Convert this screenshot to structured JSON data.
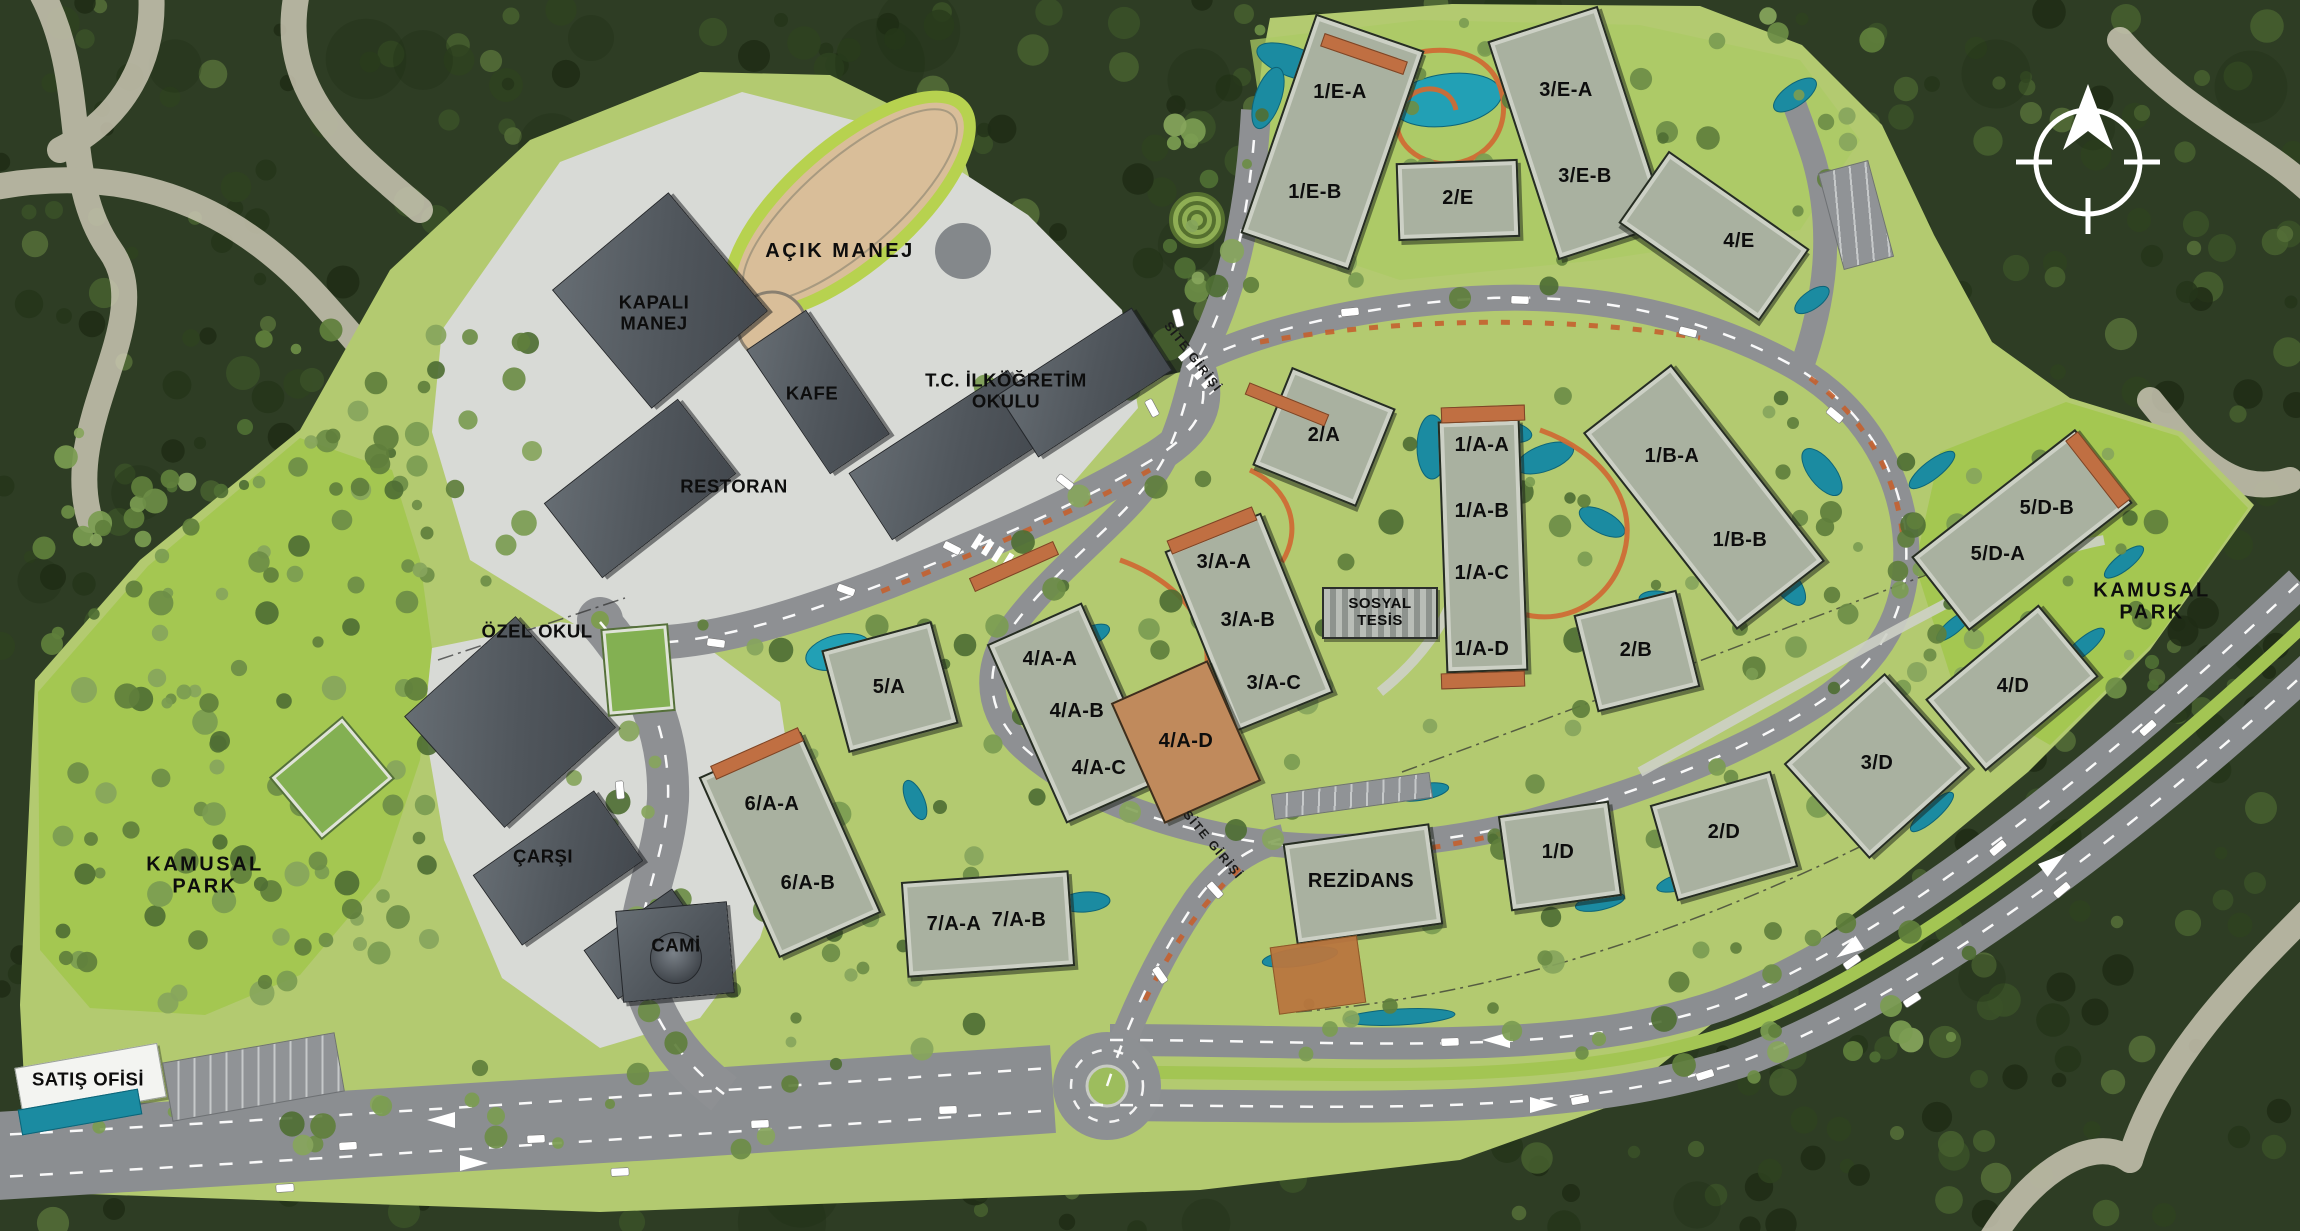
{
  "site_plan": {
    "colors": {
      "forest": "#2e3d24",
      "site_green": "#b3ca70",
      "park_green": "#a4c751",
      "road": "#8e9093",
      "pavement": "#d8dad6",
      "roof": "#a9b1a0",
      "roof_dark": "#53585d",
      "terracotta": "#c06f42",
      "water": "#1b8ba1",
      "trail_orange": "#cf6b35",
      "label": "#0d0d0d",
      "compass": "#ffffff"
    },
    "area_labels": [
      {
        "text": "KAMUSAL\nPARK",
        "x": 205,
        "y": 876
      },
      {
        "text": "KAMUSAL\nPARK",
        "x": 2152,
        "y": 602
      },
      {
        "text": "AÇIK MANEJ",
        "x": 840,
        "y": 251
      }
    ],
    "road_labels": [
      {
        "text": "SİTE GİRİŞİ",
        "x": 1193,
        "y": 357,
        "rot": 52
      },
      {
        "text": "SİTE GİRİŞİ",
        "x": 1213,
        "y": 845,
        "rot": 50
      }
    ],
    "buildings": [
      {
        "name": "block-1E",
        "kind": "res",
        "x": 1332,
        "y": 142,
        "w": 115,
        "h": 232,
        "rot": 19,
        "labels": [
          {
            "t": "1/E-A",
            "x": 1340,
            "y": 92
          },
          {
            "t": "1/E-B",
            "x": 1315,
            "y": 192
          }
        ]
      },
      {
        "name": "block-2E",
        "kind": "res",
        "x": 1458,
        "y": 200,
        "w": 122,
        "h": 78,
        "rot": -2,
        "labels": [
          {
            "t": "2/E",
            "x": 1458,
            "y": 198
          }
        ]
      },
      {
        "name": "block-3E",
        "kind": "res",
        "x": 1578,
        "y": 133,
        "w": 116,
        "h": 230,
        "rot": -18,
        "labels": [
          {
            "t": "3/E-A",
            "x": 1566,
            "y": 90
          },
          {
            "t": "3/E-B",
            "x": 1585,
            "y": 176
          }
        ]
      },
      {
        "name": "block-4E",
        "kind": "res",
        "x": 1714,
        "y": 236,
        "w": 172,
        "h": 88,
        "rot": 35,
        "labels": [
          {
            "t": "4/E",
            "x": 1739,
            "y": 241
          }
        ]
      },
      {
        "name": "block-2A",
        "kind": "res",
        "x": 1324,
        "y": 437,
        "w": 112,
        "h": 106,
        "rot": 22,
        "labels": [
          {
            "t": "2/A",
            "x": 1324,
            "y": 435
          }
        ]
      },
      {
        "name": "block-1A",
        "kind": "res",
        "x": 1483,
        "y": 546,
        "w": 82,
        "h": 252,
        "rot": -2,
        "labels": [
          {
            "t": "1/A-A",
            "x": 1482,
            "y": 445
          },
          {
            "t": "1/A-B",
            "x": 1482,
            "y": 511
          },
          {
            "t": "1/A-C",
            "x": 1482,
            "y": 573
          },
          {
            "t": "1/A-D",
            "x": 1482,
            "y": 649
          }
        ]
      },
      {
        "name": "block-3A",
        "kind": "res",
        "x": 1249,
        "y": 622,
        "w": 104,
        "h": 194,
        "rot": -22,
        "labels": [
          {
            "t": "3/A-A",
            "x": 1224,
            "y": 562
          },
          {
            "t": "3/A-B",
            "x": 1248,
            "y": 620
          },
          {
            "t": "3/A-C",
            "x": 1274,
            "y": 683
          }
        ]
      },
      {
        "name": "block-4A",
        "kind": "res",
        "x": 1074,
        "y": 713,
        "w": 104,
        "h": 196,
        "rot": -24,
        "labels": [
          {
            "t": "4/A-A",
            "x": 1050,
            "y": 659
          },
          {
            "t": "4/A-B",
            "x": 1077,
            "y": 711
          },
          {
            "t": "4/A-C",
            "x": 1099,
            "y": 768
          }
        ]
      },
      {
        "name": "block-4AD",
        "kind": "orange",
        "x": 1186,
        "y": 742,
        "w": 106,
        "h": 132,
        "rot": -24,
        "labels": [
          {
            "t": "4/A-D",
            "x": 1186,
            "y": 741
          }
        ]
      },
      {
        "name": "block-5A",
        "kind": "res",
        "x": 890,
        "y": 687,
        "w": 114,
        "h": 106,
        "rot": -15,
        "labels": [
          {
            "t": "5/A",
            "x": 889,
            "y": 687
          }
        ]
      },
      {
        "name": "block-6A",
        "kind": "res",
        "x": 790,
        "y": 845,
        "w": 112,
        "h": 198,
        "rot": -24,
        "labels": [
          {
            "t": "6/A-A",
            "x": 772,
            "y": 804
          },
          {
            "t": "6/A-B",
            "x": 808,
            "y": 883
          }
        ]
      },
      {
        "name": "block-7A",
        "kind": "res",
        "x": 988,
        "y": 924,
        "w": 168,
        "h": 96,
        "rot": -4,
        "labels": [
          {
            "t": "7/A-A",
            "x": 954,
            "y": 924
          },
          {
            "t": "7/A-B",
            "x": 1019,
            "y": 920
          }
        ]
      },
      {
        "name": "block-1B",
        "kind": "res",
        "x": 1704,
        "y": 497,
        "w": 112,
        "h": 250,
        "rot": -38,
        "labels": [
          {
            "t": "1/B-A",
            "x": 1672,
            "y": 456
          },
          {
            "t": "1/B-B",
            "x": 1740,
            "y": 540
          }
        ]
      },
      {
        "name": "block-2B",
        "kind": "res",
        "x": 1637,
        "y": 651,
        "w": 106,
        "h": 100,
        "rot": -14,
        "labels": [
          {
            "t": "2/B",
            "x": 1636,
            "y": 650
          }
        ]
      },
      {
        "name": "block-5D",
        "kind": "res",
        "x": 2022,
        "y": 530,
        "w": 208,
        "h": 94,
        "rot": -38,
        "labels": [
          {
            "t": "5/D-B",
            "x": 2047,
            "y": 508
          },
          {
            "t": "5/D-A",
            "x": 1998,
            "y": 554
          }
        ]
      },
      {
        "name": "block-4D",
        "kind": "res",
        "x": 2012,
        "y": 688,
        "w": 148,
        "h": 94,
        "rot": -40,
        "labels": [
          {
            "t": "4/D",
            "x": 2013,
            "y": 686
          }
        ]
      },
      {
        "name": "block-3D",
        "kind": "res",
        "x": 1877,
        "y": 766,
        "w": 136,
        "h": 128,
        "rot": -42,
        "labels": [
          {
            "t": "3/D",
            "x": 1877,
            "y": 763
          }
        ]
      },
      {
        "name": "block-2D",
        "kind": "res",
        "x": 1724,
        "y": 836,
        "w": 126,
        "h": 100,
        "rot": -16,
        "labels": [
          {
            "t": "2/D",
            "x": 1724,
            "y": 832
          }
        ]
      },
      {
        "name": "block-1D",
        "kind": "res",
        "x": 1560,
        "y": 856,
        "w": 112,
        "h": 96,
        "rot": -8,
        "labels": [
          {
            "t": "1/D",
            "x": 1558,
            "y": 852
          }
        ]
      },
      {
        "name": "rezidans",
        "kind": "res",
        "x": 1363,
        "y": 884,
        "w": 148,
        "h": 102,
        "rot": -8,
        "labels": [
          {
            "t": "REZİDANS",
            "x": 1361,
            "y": 881
          }
        ]
      },
      {
        "name": "kapali-manej",
        "kind": "dark",
        "x": 660,
        "y": 300,
        "w": 152,
        "h": 155,
        "rot": -40,
        "labels": [
          {
            "t": "KAPALI\nMANEJ",
            "x": 654,
            "y": 313,
            "cls": "fac"
          }
        ]
      },
      {
        "name": "kafe",
        "kind": "dark",
        "x": 818,
        "y": 392,
        "w": 72,
        "h": 150,
        "rot": -34,
        "labels": [
          {
            "t": "KAFE",
            "x": 812,
            "y": 394,
            "cls": "fac"
          }
        ]
      },
      {
        "name": "okul-wing-a",
        "kind": "dark",
        "x": 950,
        "y": 455,
        "w": 190,
        "h": 80,
        "rot": -33
      },
      {
        "name": "okul-wing-b",
        "kind": "dark",
        "x": 1085,
        "y": 382,
        "w": 160,
        "h": 75,
        "rot": -33,
        "labels": [
          {
            "t": "T.C. İLKÖĞRETİM\nOKULU",
            "x": 1006,
            "y": 391,
            "cls": "fac"
          }
        ]
      },
      {
        "name": "restoran",
        "kind": "dark",
        "x": 640,
        "y": 488,
        "w": 170,
        "h": 95,
        "rot": -38,
        "labels": [
          {
            "t": "RESTORAN",
            "x": 734,
            "y": 487,
            "cls": "fac"
          }
        ]
      },
      {
        "name": "ozel-okul",
        "kind": "dark",
        "x": 510,
        "y": 722,
        "w": 150,
        "h": 150,
        "rot": -42,
        "labels": [
          {
            "t": "ÖZEL OKUL",
            "x": 537,
            "y": 632,
            "cls": "fac"
          }
        ]
      },
      {
        "name": "carsi",
        "kind": "dark",
        "x": 558,
        "y": 868,
        "w": 148,
        "h": 86,
        "rot": -35,
        "labels": [
          {
            "t": "ÇARŞI",
            "x": 543,
            "y": 857,
            "cls": "fac"
          }
        ]
      },
      {
        "name": "carsi-2",
        "kind": "dark",
        "x": 645,
        "y": 944,
        "w": 108,
        "h": 60,
        "rot": -35
      },
      {
        "name": "cami",
        "kind": "dark",
        "x": 675,
        "y": 952,
        "w": 112,
        "h": 92,
        "rot": -5,
        "labels": [
          {
            "t": "CAMİ",
            "x": 676,
            "y": 946,
            "cls": "fac"
          }
        ]
      },
      {
        "name": "cami-dome",
        "kind": "dome",
        "x": 676,
        "y": 958,
        "w": 52,
        "h": 52,
        "rot": 0
      },
      {
        "name": "sosyal-tesis",
        "kind": "striped",
        "x": 1380,
        "y": 613,
        "w": 116,
        "h": 52,
        "rot": 0,
        "labels": [
          {
            "t": "SOSYAL\nTESİS",
            "x": 1380,
            "y": 613,
            "cls": "small"
          }
        ]
      },
      {
        "name": "satis-ofisi",
        "kind": "white",
        "x": 90,
        "y": 1082,
        "w": 145,
        "h": 55,
        "rot": -10,
        "labels": [
          {
            "t": "SATIŞ OFİSİ",
            "x": 88,
            "y": 1080,
            "cls": "fac"
          }
        ]
      },
      {
        "name": "satis-pool",
        "kind": "pool",
        "x": 80,
        "y": 1112,
        "w": 122,
        "h": 26,
        "rot": -10
      },
      {
        "name": "rezidans-court",
        "kind": "orange2",
        "x": 1318,
        "y": 975,
        "w": 88,
        "h": 68,
        "rot": -8
      },
      {
        "name": "cap-1a-top",
        "kind": "cap",
        "x": 1483,
        "y": 414,
        "w": 84,
        "h": 16,
        "rot": -2
      },
      {
        "name": "cap-1a-btm",
        "kind": "cap",
        "x": 1483,
        "y": 680,
        "w": 84,
        "h": 16,
        "rot": -2
      },
      {
        "name": "cap-3a",
        "kind": "cap",
        "x": 1212,
        "y": 530,
        "w": 92,
        "h": 15,
        "rot": -22
      },
      {
        "name": "cap-4a",
        "kind": "cap",
        "x": 1014,
        "y": 566,
        "w": 92,
        "h": 15,
        "rot": -24
      },
      {
        "name": "cap-6a",
        "kind": "cap",
        "x": 757,
        "y": 753,
        "w": 96,
        "h": 15,
        "rot": -24
      },
      {
        "name": "cap-1e",
        "kind": "cap",
        "x": 1364,
        "y": 54,
        "w": 88,
        "h": 14,
        "rot": 19
      },
      {
        "name": "cap-5d",
        "kind": "cap",
        "x": 2098,
        "y": 470,
        "w": 16,
        "h": 86,
        "rot": -38
      },
      {
        "name": "cap-2a",
        "kind": "cap",
        "x": 1287,
        "y": 404,
        "w": 86,
        "h": 13,
        "rot": 22
      },
      {
        "name": "sport-court-1",
        "kind": "court",
        "x": 332,
        "y": 778,
        "w": 92,
        "h": 78,
        "rot": -40
      },
      {
        "name": "sport-court-2",
        "kind": "court",
        "x": 638,
        "y": 670,
        "w": 64,
        "h": 84,
        "rot": -5
      },
      {
        "name": "parking-satis",
        "kind": "parking",
        "x": 253,
        "y": 1077,
        "w": 175,
        "h": 60,
        "rot": -10
      },
      {
        "name": "parking-4e",
        "kind": "parking",
        "x": 1856,
        "y": 215,
        "w": 52,
        "h": 100,
        "rot": -15
      },
      {
        "name": "parking-rezidans",
        "kind": "parking",
        "x": 1352,
        "y": 796,
        "w": 160,
        "h": 26,
        "rot": -8
      }
    ]
  }
}
